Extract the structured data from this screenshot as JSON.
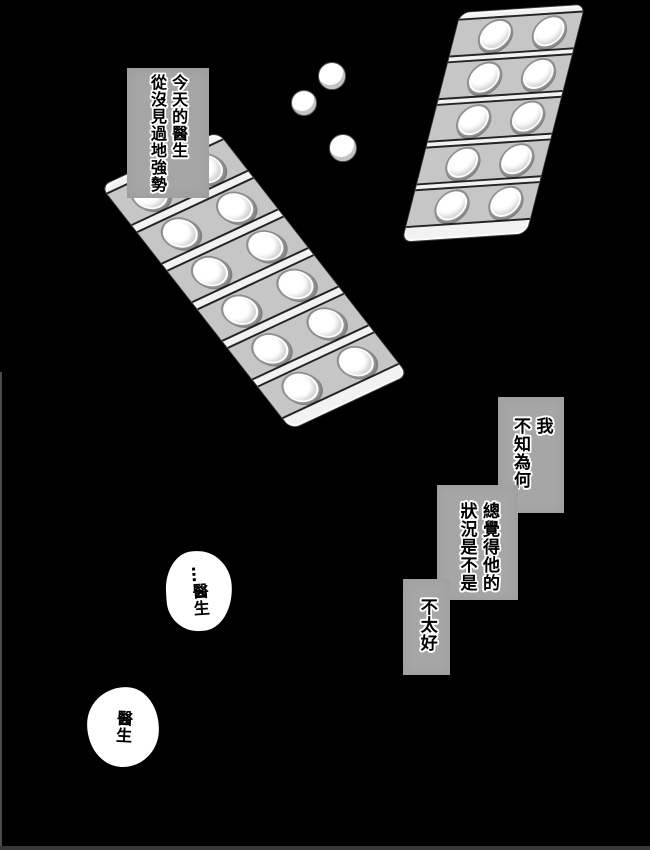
{
  "page": {
    "type": "manga-page",
    "background": "#000000"
  },
  "colors": {
    "background": "#000000",
    "panel_gray": "#a6a6a6",
    "band_gray": "#c6c6c6",
    "pack_light": "#f2f2f2",
    "pill_white": "#ffffff",
    "text": "#000000",
    "text_outline": "#ffffff"
  },
  "narration_box": {
    "text": "今天的醫生\n從沒見過地強勢"
  },
  "thought_panel": {
    "steps": [
      {
        "text": "我\n不知為何"
      },
      {
        "text": "總覺得他的\n狀況是不是"
      },
      {
        "text": "不太好"
      }
    ]
  },
  "speech_bubbles": [
    {
      "text": "…醫生"
    },
    {
      "text": "醫生"
    }
  ],
  "blister_packs": [
    {
      "name": "top-right-pack",
      "rows": 5,
      "pills_per_row": 2
    },
    {
      "name": "center-left-pack",
      "rows": 6,
      "pills_per_row": 2
    }
  ],
  "loose_pills": {
    "count": 3
  }
}
